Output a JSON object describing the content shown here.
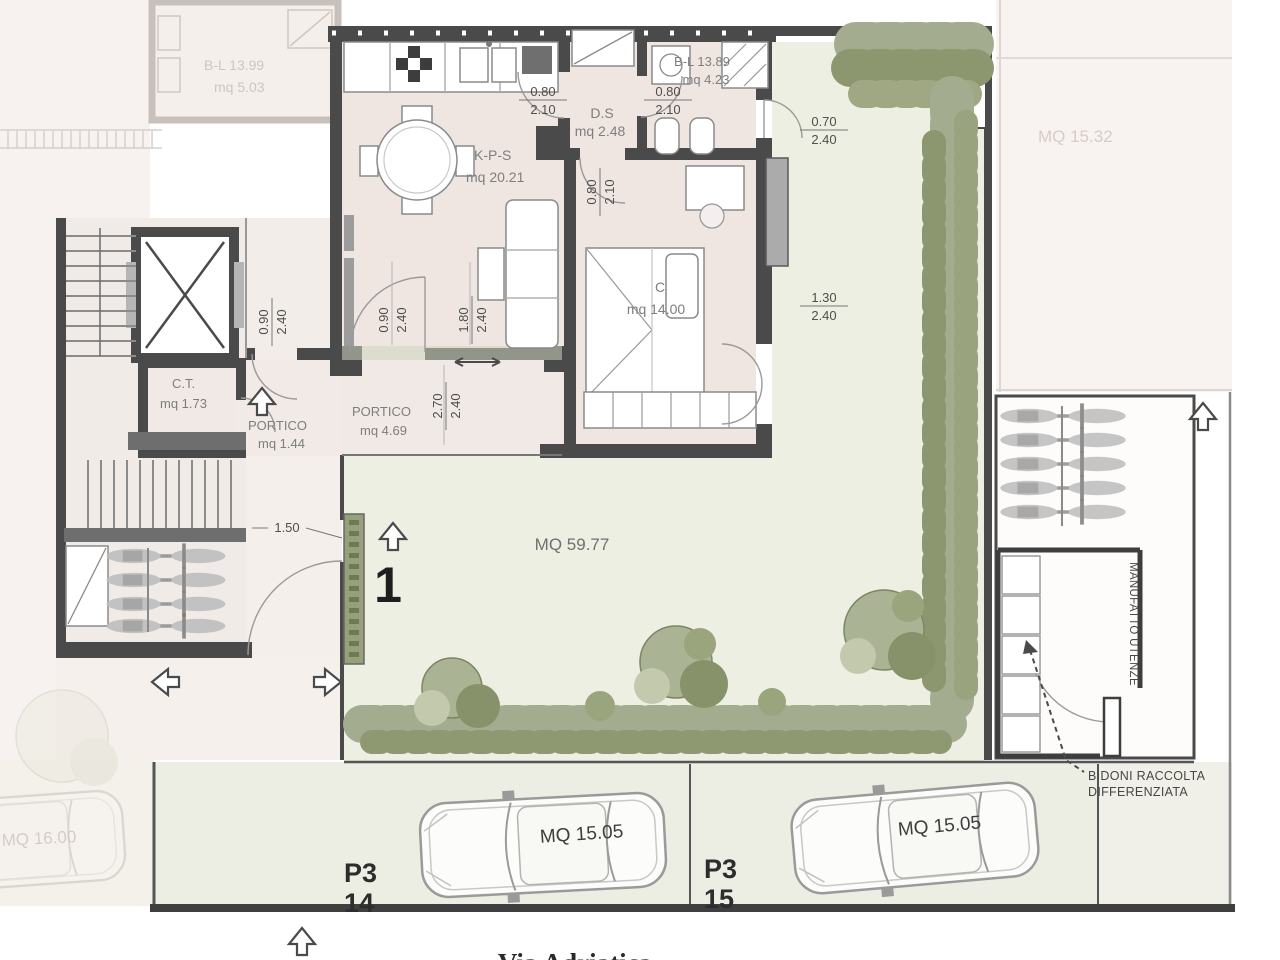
{
  "meta": {
    "unit_number": "1",
    "street": "Via Adriatica"
  },
  "rooms": {
    "kps": {
      "name": "K-P-S",
      "area": "mq 20.21"
    },
    "ds": {
      "name": "D.S",
      "area": "mq 2.48"
    },
    "bl": {
      "name": "B-L 13.89",
      "area": "mq 4.23"
    },
    "camera": {
      "name": "C",
      "area": "mq 14.00"
    },
    "ct": {
      "name": "C.T.",
      "area": "mq 1.73"
    },
    "portico1": {
      "name": "PORTICO",
      "area": "mq 1.44"
    },
    "portico2": {
      "name": "PORTICO",
      "area": "mq 4.69"
    },
    "garden": {
      "area": "MQ 59.77"
    }
  },
  "adjacent": {
    "bl2": {
      "name": "B-L 13.99",
      "area": "mq 5.03"
    },
    "garden2": {
      "area": "MQ 15.32"
    },
    "parking0": {
      "area": "MQ 16.00"
    }
  },
  "parking": {
    "spot1": {
      "line1": "P3",
      "line2": "14",
      "area": "MQ 15.05"
    },
    "spot2": {
      "line1": "P3",
      "line2": "15",
      "area": "MQ 15.05"
    }
  },
  "labels": {
    "bins1": "BIDONI RACCOLTA",
    "bins2": "DIFFERENZIATA",
    "utility": "MANUFATTO UTENZE"
  },
  "dims": {
    "ds_door": {
      "a": "0.80",
      "b": "2.10"
    },
    "bl_door": {
      "a": "0.80",
      "b": "2.10"
    },
    "bath_ext_door": {
      "a": "0.70",
      "b": "2.40"
    },
    "bedroom_window": {
      "a": "1.30",
      "b": "2.40"
    },
    "bedroom_door": {
      "a": "0.80",
      "b": "2.10"
    },
    "hall_door": {
      "a": "0.90",
      "b": "2.40"
    },
    "entry_door": {
      "a": "0.90",
      "b": "2.40"
    },
    "living_window": {
      "a": "1.80",
      "b": "2.40"
    },
    "portico_open": {
      "a": "2.70",
      "b": "2.40"
    },
    "gate_width": "1.50"
  },
  "colors": {
    "wall": "#4a4a4a",
    "interior": "#efe6e2",
    "garden": "#ecefe2",
    "hedge": "#96a17c",
    "faded": "#f6f0ee"
  }
}
